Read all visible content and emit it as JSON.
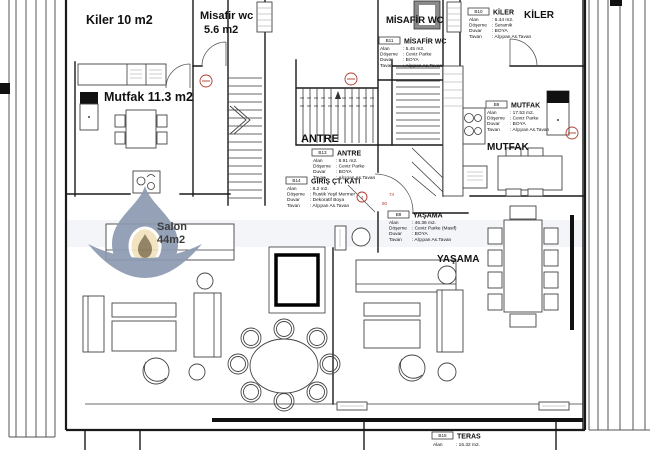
{
  "plan": {
    "room_labels": {
      "kiler_left": "Kiler 10 m2",
      "misafir_wc_left_1": "Misafir wc",
      "misafir_wc_left_2": "5.6 m2",
      "mutfak_left": "Mutfak 11.3 m2",
      "salon_1": "Salon",
      "salon_2": "44m2",
      "antre": "ANTRE",
      "misafir_wc_right": "MİSAFİR WC",
      "kiler_right": "KİLER",
      "mutfak_right": "MUTFAK",
      "yasama": "YAŞAMA"
    },
    "door_annotations": {
      "width": "74",
      "angle": "90",
      "door_no": "4"
    },
    "info_boxes": [
      {
        "id": "B10",
        "title": "KİLER",
        "rows": [
          [
            "Alan",
            ": 6.44  m2."
          ],
          [
            "Döşeme",
            ": Seramik"
          ],
          [
            "Duvar",
            ": BOYA"
          ],
          [
            "Tavan",
            ": Alçıpan As.Tavan"
          ]
        ]
      },
      {
        "id": "B11",
        "title": "MİSAFİR WC",
        "rows": [
          [
            "Alan",
            ": 5.45  m2."
          ],
          [
            "Döşeme",
            ": Ceviz Parke"
          ],
          [
            "Duvar",
            ": BOYA"
          ],
          [
            "Tavan",
            ": Alçıpan As.Tavan"
          ]
        ]
      },
      {
        "id": "B13",
        "title": "ANTRE",
        "rows": [
          [
            "Alan",
            ": 8.91  m2."
          ],
          [
            "Döşeme",
            ": Ceviz Parke"
          ],
          [
            "Duvar",
            ": BOYA"
          ],
          [
            "Tavan",
            ": Alçıpan As.Tavan"
          ]
        ]
      },
      {
        "id": "B14",
        "title": "GİRİŞ ÇT. KATI",
        "rows": [
          [
            "Alan",
            ": 8.2  m2."
          ],
          [
            "Döşeme",
            ": Rustik Yeşil Mermer"
          ],
          [
            "Duvar",
            ": Dekoratif Boya"
          ],
          [
            "Tavan",
            ": Alçıpan As.Tavan"
          ]
        ]
      },
      {
        "id": "B9",
        "title": "MUTFAK",
        "rows": [
          [
            "Alan",
            ": 17.53  m2."
          ],
          [
            "Döşeme",
            ": Ceviz Parke"
          ],
          [
            "Duvar",
            ": BOYA"
          ],
          [
            "Tavan",
            ": Alçıpan As.Tavan"
          ]
        ]
      },
      {
        "id": "B8",
        "title": "YAŞAMA",
        "rows": [
          [
            "Alan",
            ": 46.36  m2."
          ],
          [
            "Döşeme",
            ": Ceviz Parke (Masif)"
          ],
          [
            "Duvar",
            ": BOYA"
          ],
          [
            "Tavan",
            ": Alçıpan As.Tavan"
          ]
        ]
      },
      {
        "id": "B15",
        "title": "TERAS",
        "rows": [
          [
            "Alan",
            ": 15.32  m2."
          ]
        ]
      }
    ],
    "colors": {
      "watermark_blue": "#8d9ab0",
      "watermark_cream": "#f2e2bc",
      "watermark_core": "#8a7a5a",
      "annotation_red": "#b03a2e"
    }
  }
}
